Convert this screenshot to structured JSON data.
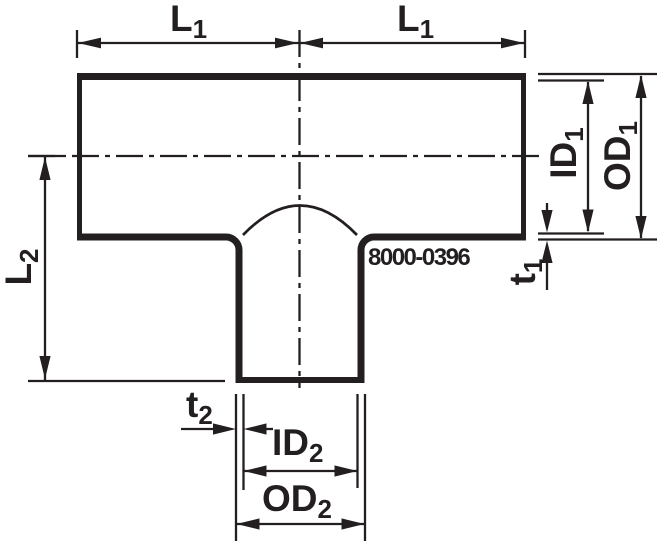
{
  "drawing": {
    "name": "reducing-tee-dimension-drawing",
    "part_number": "8000-0396",
    "colors": {
      "line": "#231f20",
      "background": "#ffffff"
    },
    "labels": {
      "l1_left": {
        "base": "L",
        "sub": "1"
      },
      "l1_right": {
        "base": "L",
        "sub": "1"
      },
      "l2": {
        "base": "L",
        "sub": "2"
      },
      "id1": {
        "base": "ID",
        "sub": "1"
      },
      "od1": {
        "base": "OD",
        "sub": "1"
      },
      "t1": {
        "base": "t",
        "sub": "1"
      },
      "t2": {
        "base": "t",
        "sub": "2"
      },
      "id2": {
        "base": "ID",
        "sub": "2"
      },
      "od2": {
        "base": "OD",
        "sub": "2"
      }
    }
  }
}
